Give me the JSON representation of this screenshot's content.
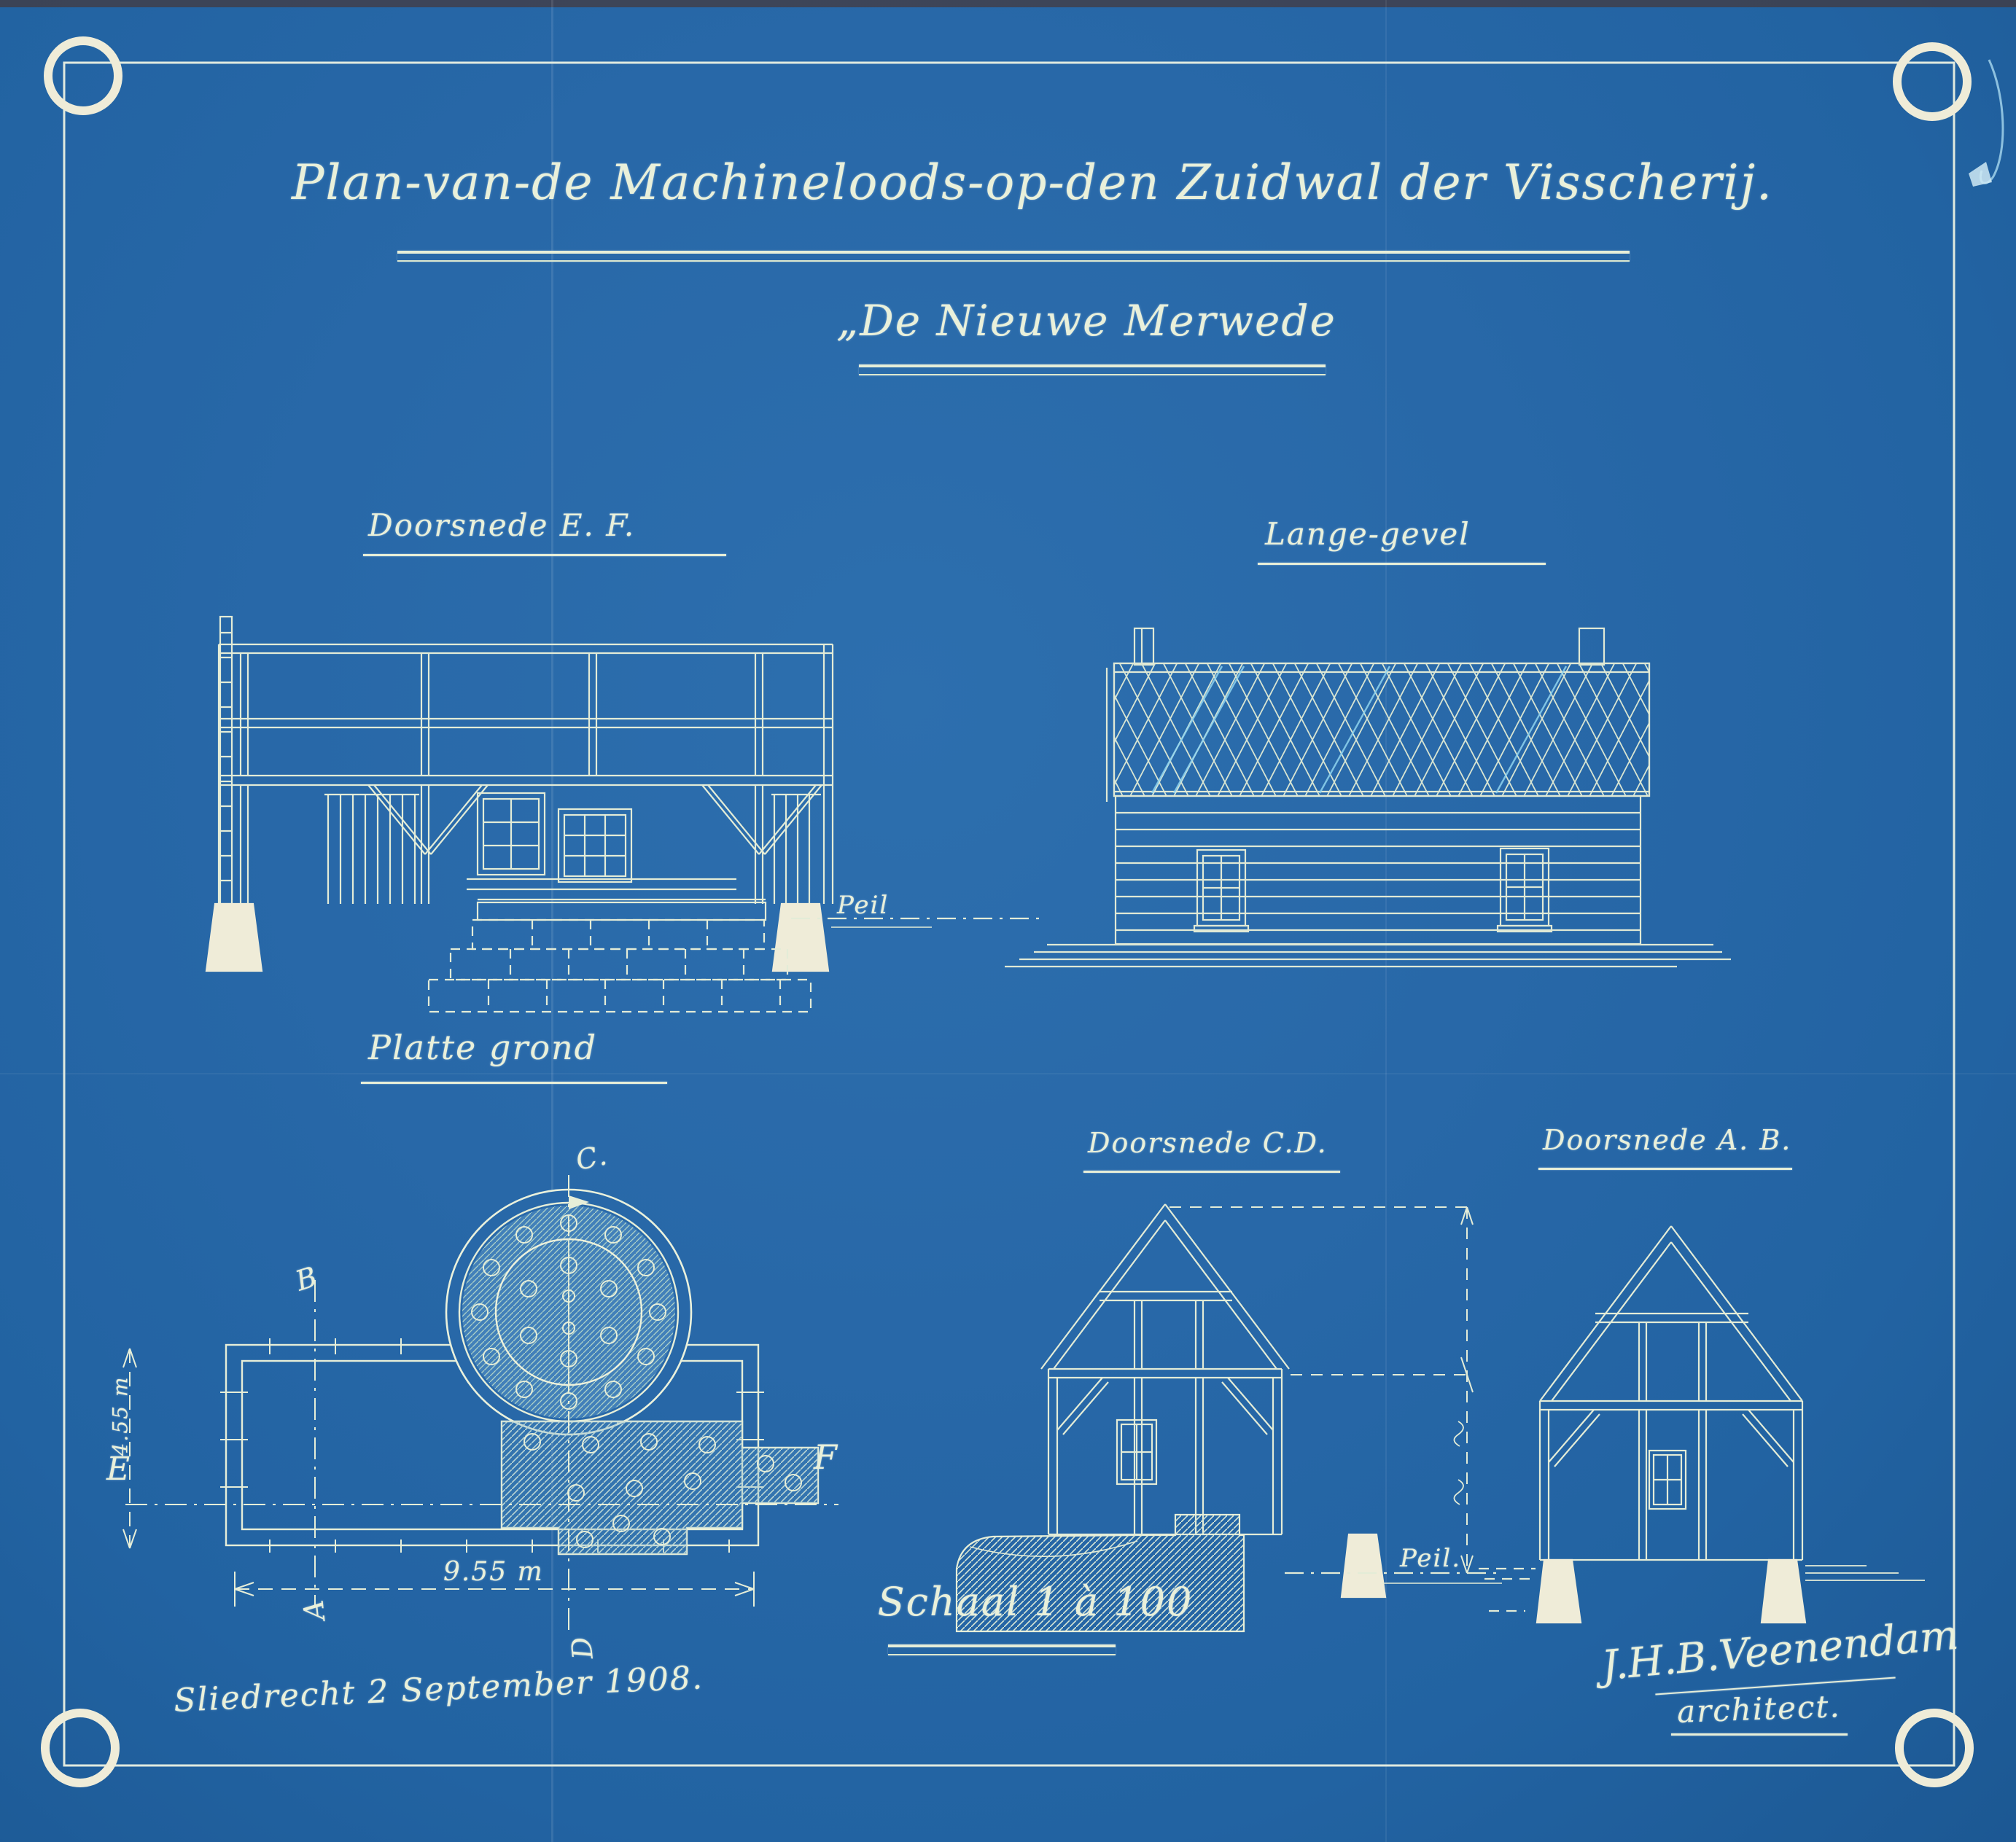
{
  "document": {
    "kind": "architectural blueprint (cyanotype)",
    "title": "Plan-van-de Machineloods-op-den Zuidwal der Visscherij.",
    "subtitle": "„De Nieuwe Merwede",
    "scale_label": "Schaal 1 à 100",
    "place_date": "Sliedrecht 2 September 1908.",
    "signature_name": "J.H.B.Veenendam",
    "signature_title": "architect."
  },
  "sections": {
    "doorsnede_ef": {
      "label": "Doorsnede E. F.",
      "peil": "Peil"
    },
    "lange_gevel": {
      "label": "Lange-gevel"
    },
    "platte_grond": {
      "label": "Platte grond",
      "width_dim": "9.55 m",
      "depth_dim": "4.55 m",
      "markers": {
        "a": "A",
        "b": "B",
        "c": "C.",
        "d": "D",
        "e": "E",
        "f": "F"
      }
    },
    "doorsnede_cd": {
      "label": "Doorsnede C.D.",
      "peil": "Peil."
    },
    "doorsnede_ab": {
      "label": "Doorsnede A. B."
    }
  },
  "colors": {
    "paper_blue": "#2868a8",
    "line_cream": "#e9f0da",
    "accent_cyan": "#8fd3ee",
    "footing_white": "#efecd8"
  }
}
